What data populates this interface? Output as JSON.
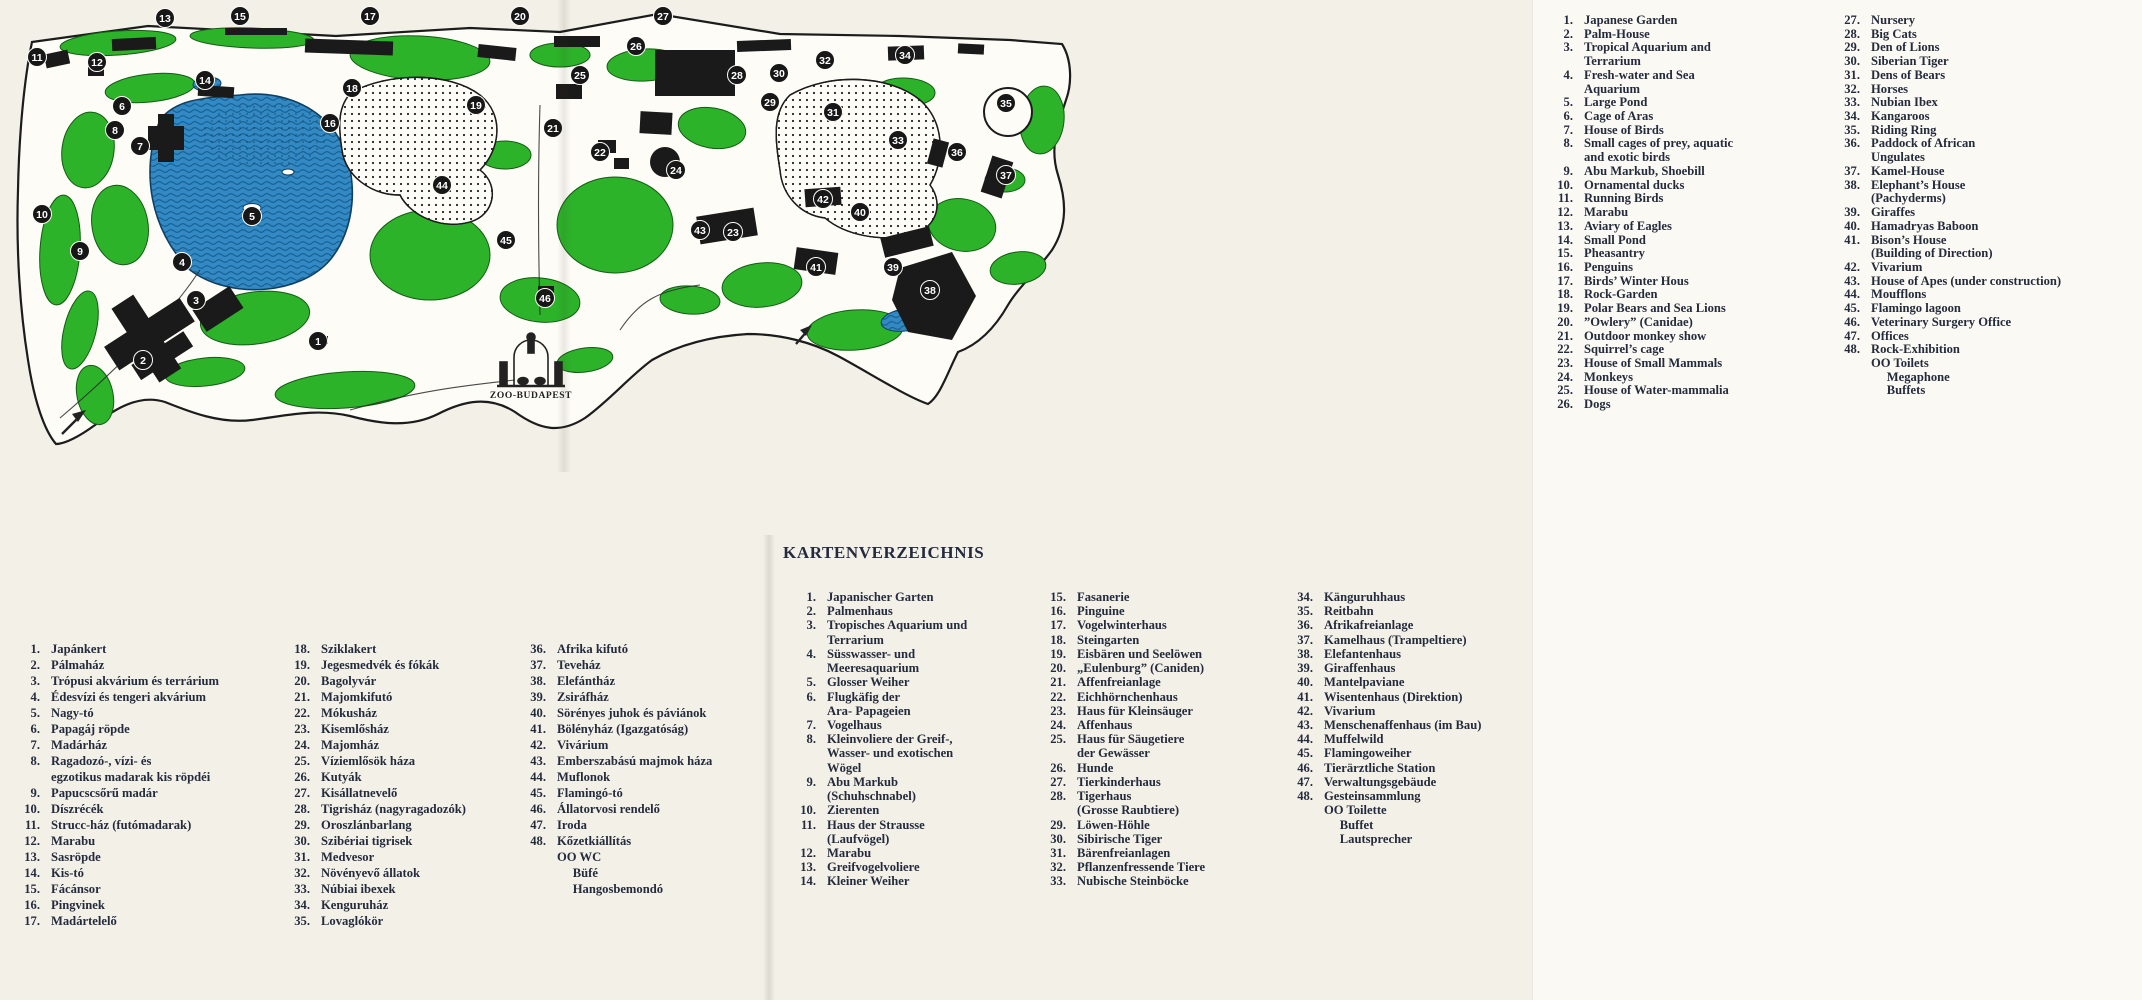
{
  "map": {
    "logo_text": "ZOO-BUDAPEST",
    "colors": {
      "green": "#2cb32a",
      "water": "#3289c4",
      "water_line": "#155d8e",
      "ink": "#1c1c1c",
      "paper": "#fdfcf7"
    },
    "markers": [
      {
        "n": "13",
        "x": 165,
        "y": 18
      },
      {
        "n": "15",
        "x": 240,
        "y": 16
      },
      {
        "n": "17",
        "x": 370,
        "y": 16
      },
      {
        "n": "20",
        "x": 520,
        "y": 16
      },
      {
        "n": "27",
        "x": 663,
        "y": 16
      },
      {
        "n": "26",
        "x": 636,
        "y": 46
      },
      {
        "n": "25",
        "x": 580,
        "y": 75
      },
      {
        "n": "28",
        "x": 737,
        "y": 75
      },
      {
        "n": "30",
        "x": 779,
        "y": 73
      },
      {
        "n": "32",
        "x": 825,
        "y": 60
      },
      {
        "n": "34",
        "x": 905,
        "y": 55
      },
      {
        "n": "35",
        "x": 1006,
        "y": 103
      },
      {
        "n": "29",
        "x": 770,
        "y": 102
      },
      {
        "n": "31",
        "x": 833,
        "y": 112
      },
      {
        "n": "33",
        "x": 898,
        "y": 140
      },
      {
        "n": "36",
        "x": 957,
        "y": 152
      },
      {
        "n": "37",
        "x": 1006,
        "y": 175
      },
      {
        "n": "12",
        "x": 97,
        "y": 62
      },
      {
        "n": "11",
        "x": 37,
        "y": 57
      },
      {
        "n": "14",
        "x": 205,
        "y": 80
      },
      {
        "n": "18",
        "x": 352,
        "y": 88
      },
      {
        "n": "19",
        "x": 476,
        "y": 105
      },
      {
        "n": "16",
        "x": 330,
        "y": 123
      },
      {
        "n": "8",
        "x": 115,
        "y": 130
      },
      {
        "n": "6",
        "x": 122,
        "y": 106
      },
      {
        "n": "7",
        "x": 140,
        "y": 146
      },
      {
        "n": "21",
        "x": 553,
        "y": 128
      },
      {
        "n": "22",
        "x": 600,
        "y": 152
      },
      {
        "n": "24",
        "x": 676,
        "y": 170
      },
      {
        "n": "44",
        "x": 442,
        "y": 185
      },
      {
        "n": "42",
        "x": 823,
        "y": 199
      },
      {
        "n": "40",
        "x": 860,
        "y": 212
      },
      {
        "n": "10",
        "x": 42,
        "y": 214
      },
      {
        "n": "5",
        "x": 252,
        "y": 216
      },
      {
        "n": "43",
        "x": 700,
        "y": 230
      },
      {
        "n": "23",
        "x": 733,
        "y": 232
      },
      {
        "n": "9",
        "x": 80,
        "y": 251
      },
      {
        "n": "45",
        "x": 506,
        "y": 240
      },
      {
        "n": "4",
        "x": 182,
        "y": 262
      },
      {
        "n": "41",
        "x": 816,
        "y": 267
      },
      {
        "n": "39",
        "x": 893,
        "y": 267
      },
      {
        "n": "3",
        "x": 196,
        "y": 300
      },
      {
        "n": "38",
        "x": 930,
        "y": 290
      },
      {
        "n": "46",
        "x": 545,
        "y": 298
      },
      {
        "n": "1",
        "x": 318,
        "y": 341
      },
      {
        "n": "2",
        "x": 143,
        "y": 360
      }
    ]
  },
  "legend_en": {
    "col1": [
      {
        "n": "1.",
        "t": "Japanese Garden"
      },
      {
        "n": "2.",
        "t": "Palm-House"
      },
      {
        "n": "3.",
        "t": "Tropical Aquarium and\nTerrarium"
      },
      {
        "n": "4.",
        "t": "Fresh-water and Sea\nAquarium"
      },
      {
        "n": "5.",
        "t": "Large Pond"
      },
      {
        "n": "6.",
        "t": "Cage of Aras"
      },
      {
        "n": "7.",
        "t": "House of Birds"
      },
      {
        "n": "8.",
        "t": "Small cages of prey, aquatic\nand exotic birds"
      },
      {
        "n": "9.",
        "t": "Abu Markub, Shoebill"
      },
      {
        "n": "10.",
        "t": "Ornamental ducks"
      },
      {
        "n": "11.",
        "t": "Running Birds"
      },
      {
        "n": "12.",
        "t": "Marabu"
      },
      {
        "n": "13.",
        "t": "Aviary of Eagles"
      },
      {
        "n": "14.",
        "t": "Small Pond"
      },
      {
        "n": "15.",
        "t": "Pheasantry"
      },
      {
        "n": "16.",
        "t": "Penguins"
      },
      {
        "n": "17.",
        "t": "Birds’ Winter Hous"
      },
      {
        "n": "18.",
        "t": "Rock-Garden"
      },
      {
        "n": "19.",
        "t": "Polar Bears and Sea Lions"
      },
      {
        "n": "20.",
        "t": "”Owlery” (Canidae)"
      },
      {
        "n": "21.",
        "t": "Outdoor monkey show"
      },
      {
        "n": "22.",
        "t": "Squirrel’s cage"
      },
      {
        "n": "23.",
        "t": "House of Small Mammals"
      },
      {
        "n": "24.",
        "t": "Monkeys"
      },
      {
        "n": "25.",
        "t": "House of Water-mammalia"
      },
      {
        "n": "26.",
        "t": "Dogs"
      }
    ],
    "col2": [
      {
        "n": "27.",
        "t": "Nursery"
      },
      {
        "n": "28.",
        "t": "Big Cats"
      },
      {
        "n": "29.",
        "t": "Den of Lions"
      },
      {
        "n": "30.",
        "t": "Siberian Tiger"
      },
      {
        "n": "31.",
        "t": "Dens of Bears"
      },
      {
        "n": "32.",
        "t": "Horses"
      },
      {
        "n": "33.",
        "t": "Nubian Ibex"
      },
      {
        "n": "34.",
        "t": "Kangaroos"
      },
      {
        "n": "35.",
        "t": "Riding Ring"
      },
      {
        "n": "36.",
        "t": "Paddock of African\nUngulates"
      },
      {
        "n": "37.",
        "t": "Kamel-House"
      },
      {
        "n": "38.",
        "t": "Elephant’s House\n(Pachyderms)"
      },
      {
        "n": "39.",
        "t": "Giraffes"
      },
      {
        "n": "40.",
        "t": "Hamadryas Baboon"
      },
      {
        "n": "41.",
        "t": "Bison’s House\n(Building of Direction)"
      },
      {
        "n": "42.",
        "t": "Vivarium"
      },
      {
        "n": "43.",
        "t": "House of Apes (under construction)"
      },
      {
        "n": "44.",
        "t": "Moufflons"
      },
      {
        "n": "45.",
        "t": "Flamingo lagoon"
      },
      {
        "n": "46.",
        "t": "Veterinary Surgery Office"
      },
      {
        "n": "47.",
        "t": "Offices"
      },
      {
        "n": "48.",
        "t": "Rock-Exhibition\nOO Toilets\n     Megaphone\n     Buffets"
      }
    ]
  },
  "legend_de": {
    "title": "KARTENVERZEICHNIS",
    "col1": [
      {
        "n": "1.",
        "t": "Japanischer Garten"
      },
      {
        "n": "2.",
        "t": "Palmenhaus"
      },
      {
        "n": "3.",
        "t": "Tropisches Aquarium und\nTerrarium"
      },
      {
        "n": "4.",
        "t": "Süsswasser- und\nMeeresaquarium"
      },
      {
        "n": "5.",
        "t": "Glosser Weiher"
      },
      {
        "n": "6.",
        "t": "Flugkäfig der\nAra- Papageien"
      },
      {
        "n": "7.",
        "t": "Vogelhaus"
      },
      {
        "n": "8.",
        "t": "Kleinvoliere der Greif-,\nWasser- und exotischen\nWögel"
      },
      {
        "n": "9.",
        "t": "Abu Markub\n(Schuhschnabel)"
      },
      {
        "n": "10.",
        "t": "Zierenten"
      },
      {
        "n": "11.",
        "t": "Haus der Strausse\n(Laufvögel)"
      },
      {
        "n": "12.",
        "t": "Marabu"
      },
      {
        "n": "13.",
        "t": "Greifvogelvoliere"
      },
      {
        "n": "14.",
        "t": "Kleiner Weiher"
      }
    ],
    "col2": [
      {
        "n": "15.",
        "t": "Fasanerie"
      },
      {
        "n": "16.",
        "t": "Pinguine"
      },
      {
        "n": "17.",
        "t": "Vogelwinterhaus"
      },
      {
        "n": "18.",
        "t": "Steingarten"
      },
      {
        "n": "19.",
        "t": "Eisbären und Seelöwen"
      },
      {
        "n": "20.",
        "t": "„Eulenburg” (Caniden)"
      },
      {
        "n": "21.",
        "t": "Affenfreianlage"
      },
      {
        "n": "22.",
        "t": "Eichhörnchenhaus"
      },
      {
        "n": "23.",
        "t": "Haus für Kleinsäuger"
      },
      {
        "n": "24.",
        "t": "Affenhaus"
      },
      {
        "n": "25.",
        "t": "Haus für Säugetiere\nder Gewässer"
      },
      {
        "n": "26.",
        "t": "Hunde"
      },
      {
        "n": "27.",
        "t": "Tierkinderhaus"
      },
      {
        "n": "28.",
        "t": "Tigerhaus\n(Grosse Raubtiere)"
      },
      {
        "n": "29.",
        "t": "Löwen-Höhle"
      },
      {
        "n": "30.",
        "t": "Sibirische Tiger"
      },
      {
        "n": "31.",
        "t": "Bärenfreianlagen"
      },
      {
        "n": "32.",
        "t": "Pflanzenfressende Tiere"
      },
      {
        "n": "33.",
        "t": "Nubische Steinböcke"
      }
    ],
    "col3": [
      {
        "n": "34.",
        "t": "Känguruhhaus"
      },
      {
        "n": "35.",
        "t": "Reitbahn"
      },
      {
        "n": "36.",
        "t": "Afrikafreianlage"
      },
      {
        "n": "37.",
        "t": "Kamelhaus (Trampeltiere)"
      },
      {
        "n": "38.",
        "t": "Elefantenhaus"
      },
      {
        "n": "39.",
        "t": "Giraffenhaus"
      },
      {
        "n": "40.",
        "t": "Mantelpaviane"
      },
      {
        "n": "41.",
        "t": "Wisentenhaus (Direktion)"
      },
      {
        "n": "42.",
        "t": "Vivarium"
      },
      {
        "n": "43.",
        "t": "Menschenaffenhaus (im Bau)"
      },
      {
        "n": "44.",
        "t": "Muffelwild"
      },
      {
        "n": "45.",
        "t": "Flamingoweiher"
      },
      {
        "n": "46.",
        "t": "Tierärztliche Station"
      },
      {
        "n": "47.",
        "t": "Verwaltungsgebäude"
      },
      {
        "n": "48.",
        "t": "Gesteinsammlung\nOO Toilette\n     Buffet\n     Lautsprecher"
      }
    ]
  },
  "legend_hu": {
    "col1": [
      {
        "n": "1.",
        "t": "Japánkert"
      },
      {
        "n": "2.",
        "t": "Pálmaház"
      },
      {
        "n": "3.",
        "t": "Trópusi akvárium és terrárium"
      },
      {
        "n": "4.",
        "t": "Édesvízi és tengeri akvárium"
      },
      {
        "n": "5.",
        "t": "Nagy-tó"
      },
      {
        "n": "6.",
        "t": "Papagáj röpde"
      },
      {
        "n": "7.",
        "t": "Madárház"
      },
      {
        "n": "8.",
        "t": "Ragadozó-, vízi- és\negzotikus madarak kis röpdéi"
      },
      {
        "n": "9.",
        "t": "Papucscsőrű madár"
      },
      {
        "n": "10.",
        "t": "Díszrécék"
      },
      {
        "n": "11.",
        "t": "Strucc-ház (futómadarak)"
      },
      {
        "n": "12.",
        "t": "Marabu"
      },
      {
        "n": "13.",
        "t": "Sasröpde"
      },
      {
        "n": "14.",
        "t": "Kis-tó"
      },
      {
        "n": "15.",
        "t": "Fácánsor"
      },
      {
        "n": "16.",
        "t": "Pingvinek"
      },
      {
        "n": "17.",
        "t": "Madártelelő"
      }
    ],
    "col2": [
      {
        "n": "18.",
        "t": "Sziklakert"
      },
      {
        "n": "19.",
        "t": "Jegesmedvék és fókák"
      },
      {
        "n": "20.",
        "t": "Bagolyvár"
      },
      {
        "n": "21.",
        "t": "Majomkifutó"
      },
      {
        "n": "22.",
        "t": "Mókusház"
      },
      {
        "n": "23.",
        "t": "Kisemlősház"
      },
      {
        "n": "24.",
        "t": "Majomház"
      },
      {
        "n": "25.",
        "t": "Víziemlősök háza"
      },
      {
        "n": "26.",
        "t": "Kutyák"
      },
      {
        "n": "27.",
        "t": "Kisállatnevelő"
      },
      {
        "n": "28.",
        "t": "Tigrisház (nagyragadozók)"
      },
      {
        "n": "29.",
        "t": "Oroszlánbarlang"
      },
      {
        "n": "30.",
        "t": "Szibériai tigrisek"
      },
      {
        "n": "31.",
        "t": "Medvesor"
      },
      {
        "n": "32.",
        "t": "Növényevő állatok"
      },
      {
        "n": "33.",
        "t": "Núbiai ibexek"
      },
      {
        "n": "34.",
        "t": "Kenguruház"
      },
      {
        "n": "35.",
        "t": "Lovaglókör"
      }
    ],
    "col3": [
      {
        "n": "36.",
        "t": "Afrika kifutó"
      },
      {
        "n": "37.",
        "t": "Teveház"
      },
      {
        "n": "38.",
        "t": "Elefántház"
      },
      {
        "n": "39.",
        "t": "Zsiráfház"
      },
      {
        "n": "40.",
        "t": "Sörényes juhok és páviánok"
      },
      {
        "n": "41.",
        "t": "Bölényház (Igazgatóság)"
      },
      {
        "n": "42.",
        "t": "Vivárium"
      },
      {
        "n": "43.",
        "t": "Emberszabású majmok háza"
      },
      {
        "n": "44.",
        "t": "Muflonok"
      },
      {
        "n": "45.",
        "t": "Flamingó-tó"
      },
      {
        "n": "46.",
        "t": "Állatorvosi rendelő"
      },
      {
        "n": "47.",
        "t": "Iroda"
      },
      {
        "n": "48.",
        "t": "Kőzetkiállítás\nOO WC\n     Büfé\n     Hangosbemondó"
      }
    ]
  }
}
